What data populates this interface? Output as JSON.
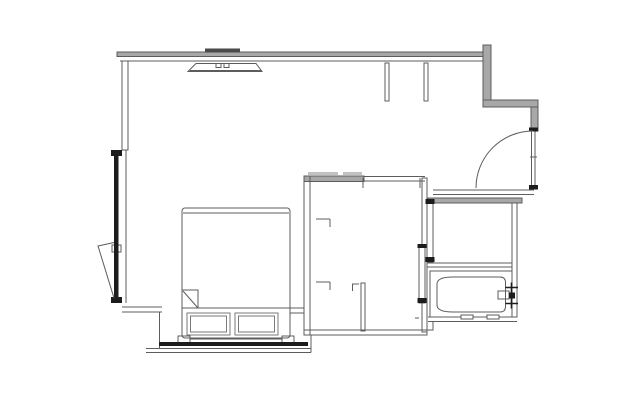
{
  "canvas": {
    "width": 640,
    "height": 400,
    "background": "#ffffff"
  },
  "colors": {
    "line": "#5c5c5c",
    "line_light": "#7a7a7a",
    "dark": "#1c1c1c",
    "mid_dark": "#4a4a4a",
    "wall_fill": "#a8a8a8",
    "wall_fill_light": "#c2c2c2",
    "white": "#ffffff"
  },
  "floorplan": {
    "elements": [
      {
        "type": "band",
        "name": "top-wall-band",
        "x": 117,
        "y": 52,
        "w": 366,
        "h": 4.5
      },
      {
        "type": "band",
        "name": "entry-left-wall-band",
        "x": 483,
        "y": 45,
        "w": 8,
        "h": 62
      },
      {
        "type": "band",
        "name": "entry-top-wall-band",
        "x": 483,
        "y": 100,
        "w": 55,
        "h": 7
      },
      {
        "type": "band",
        "name": "entry-right-wall-band",
        "x": 531,
        "y": 107,
        "w": 7,
        "h": 24
      },
      {
        "type": "band",
        "name": "bathroom-top-wall-band",
        "x": 428,
        "y": 198,
        "w": 94,
        "h": 5
      },
      {
        "type": "band",
        "name": "closet-top-wall-band",
        "x": 304,
        "y": 176,
        "w": 60,
        "h": 5.5
      },
      {
        "type": "band",
        "name": "closet-shelf-bar-1",
        "x": 308,
        "y": 172,
        "w": 30,
        "h": 3,
        "fill": "wall_fill_light",
        "nostroke": true
      },
      {
        "type": "band",
        "name": "closet-shelf-bar-2",
        "x": 343,
        "y": 172,
        "w": 19,
        "h": 3,
        "fill": "wall_fill_light",
        "nostroke": true
      },
      {
        "type": "line",
        "name": "top-wall-inner-line",
        "x1": 120,
        "y1": 61,
        "x2": 483,
        "y2": 61
      },
      {
        "type": "line",
        "name": "closet-top-wall-line-a",
        "x1": 363,
        "y1": 176.5,
        "x2": 425,
        "y2": 176.5
      },
      {
        "type": "line",
        "name": "closet-top-wall-line-b",
        "x1": 363,
        "y1": 181,
        "x2": 425,
        "y2": 181
      },
      {
        "type": "line",
        "name": "corridor-wall-line-a",
        "x1": 433,
        "y1": 190,
        "x2": 534,
        "y2": 190
      },
      {
        "type": "line",
        "name": "corridor-wall-line-b",
        "x1": 433,
        "y1": 194.5,
        "x2": 534,
        "y2": 194.5
      },
      {
        "type": "line",
        "name": "bath-divider-line-a",
        "x1": 427,
        "y1": 263,
        "x2": 512,
        "y2": 263
      },
      {
        "type": "line",
        "name": "bath-divider-line-b",
        "x1": 427,
        "y1": 267,
        "x2": 512,
        "y2": 267
      },
      {
        "type": "line",
        "name": "bath-bottom-wall-a",
        "x1": 428,
        "y1": 317,
        "x2": 517,
        "y2": 317
      },
      {
        "type": "line",
        "name": "bath-bottom-wall-b",
        "x1": 428,
        "y1": 321.5,
        "x2": 517,
        "y2": 321.5
      },
      {
        "type": "line",
        "name": "left-wall-inner-face",
        "x1": 126,
        "y1": 150,
        "x2": 126,
        "y2": 303
      },
      {
        "type": "line",
        "name": "lower-left-wall-a",
        "x1": 122,
        "y1": 307,
        "x2": 162,
        "y2": 307
      },
      {
        "type": "line",
        "name": "lower-left-wall-b",
        "x1": 122,
        "y1": 312,
        "x2": 162,
        "y2": 312
      },
      {
        "type": "line",
        "name": "lower-left-step",
        "x1": 159.5,
        "y1": 312,
        "x2": 159.5,
        "y2": 348.5
      },
      {
        "type": "line",
        "name": "headboard-ledge-a",
        "x1": 290,
        "y1": 308,
        "x2": 304,
        "y2": 308
      },
      {
        "type": "line",
        "name": "headboard-ledge-b",
        "x1": 290,
        "y1": 313,
        "x2": 304,
        "y2": 313
      },
      {
        "type": "line",
        "name": "bottom-wall-line-a",
        "x1": 146,
        "y1": 348.5,
        "x2": 311,
        "y2": 348.5
      },
      {
        "type": "line",
        "name": "bottom-wall-line-b",
        "x1": 146,
        "y1": 352.5,
        "x2": 311,
        "y2": 352.5
      },
      {
        "type": "line",
        "name": "bottom-wall-right-end",
        "x1": 311,
        "y1": 335,
        "x2": 311,
        "y2": 352.5
      },
      {
        "type": "line",
        "name": "headboard-line",
        "x1": 178,
        "y1": 339,
        "x2": 294,
        "y2": 339
      },
      {
        "type": "line",
        "name": "duvet-edge-line",
        "x1": 182,
        "y1": 308,
        "x2": 290,
        "y2": 308
      },
      {
        "type": "line",
        "name": "bed-foot-inner-line",
        "x1": 183,
        "y1": 213,
        "x2": 289,
        "y2": 213
      },
      {
        "type": "line",
        "name": "closet-jamb-tick-1",
        "x1": 363,
        "y1": 178,
        "x2": 363,
        "y2": 188
      },
      {
        "type": "line",
        "name": "closet-jamb-tick-2",
        "x1": 420,
        "y1": 178,
        "x2": 420,
        "y2": 188
      },
      {
        "type": "line",
        "name": "closet-bracket-1-h",
        "x1": 316,
        "y1": 219,
        "x2": 330,
        "y2": 219
      },
      {
        "type": "line",
        "name": "closet-bracket-1-v",
        "x1": 330,
        "y1": 219,
        "x2": 330,
        "y2": 227
      },
      {
        "type": "line",
        "name": "closet-bracket-2-h",
        "x1": 316,
        "y1": 282,
        "x2": 330,
        "y2": 282
      },
      {
        "type": "line",
        "name": "closet-bracket-2-v",
        "x1": 330,
        "y1": 282,
        "x2": 330,
        "y2": 290
      },
      {
        "type": "line",
        "name": "closet-bracket-3-h",
        "x1": 352,
        "y1": 284,
        "x2": 359,
        "y2": 284
      },
      {
        "type": "line",
        "name": "closet-bracket-3-v",
        "x1": 352.5,
        "y1": 284,
        "x2": 352.5,
        "y2": 291
      },
      {
        "type": "line",
        "name": "closet-wall-dash",
        "x1": 415,
        "y1": 318,
        "x2": 419,
        "y2": 318
      },
      {
        "type": "line",
        "name": "door-leaf-tick",
        "x1": 530,
        "y1": 157,
        "x2": 537,
        "y2": 157
      },
      {
        "type": "line",
        "name": "ac-unit-inner-line",
        "x1": 190,
        "y1": 70.5,
        "x2": 261,
        "y2": 70.5
      },
      {
        "type": "rect",
        "name": "left-wall",
        "x": 122,
        "y": 61,
        "w": 6,
        "h": 89
      },
      {
        "type": "rect",
        "name": "window-pivot-bracket",
        "x": 112,
        "y": 245,
        "w": 9,
        "h": 7,
        "fill": "white"
      },
      {
        "type": "rect",
        "name": "closet-left-wall",
        "x": 304,
        "y": 176,
        "w": 6,
        "h": 159
      },
      {
        "type": "rect",
        "name": "closet-right-wall",
        "x": 422,
        "y": 178,
        "w": 5,
        "h": 154
      },
      {
        "type": "rect",
        "name": "closet-bottom-wall",
        "x": 304,
        "y": 330,
        "w": 123,
        "h": 5
      },
      {
        "type": "rect",
        "name": "closet-divider-wall",
        "x": 361,
        "y": 283,
        "w": 4,
        "h": 48
      },
      {
        "type": "rect",
        "name": "bath-right-wall",
        "x": 512,
        "y": 203,
        "w": 5,
        "h": 114
      },
      {
        "type": "rect",
        "name": "bathtub-enclosure",
        "x": 430,
        "y": 271,
        "w": 82,
        "h": 46
      },
      {
        "type": "rect",
        "name": "bathtub-drain-tick-1",
        "x": 461,
        "y": 315,
        "w": 12,
        "h": 4,
        "fill": "white"
      },
      {
        "type": "rect",
        "name": "bathtub-drain-tick-2",
        "x": 487,
        "y": 315,
        "w": 12,
        "h": 4,
        "fill": "white"
      },
      {
        "type": "rect",
        "name": "bathtub-spout",
        "x": 498,
        "y": 291,
        "w": 11,
        "h": 8,
        "fill": "white"
      },
      {
        "type": "rect",
        "name": "sliding-door-panel-1",
        "x": 427,
        "y": 200,
        "w": 6,
        "h": 62,
        "fill": "white"
      },
      {
        "type": "rect",
        "name": "sliding-door-panel-2",
        "x": 419,
        "y": 245,
        "w": 6,
        "h": 58,
        "fill": "white"
      },
      {
        "type": "rect",
        "name": "wall-stub-1",
        "x": 385,
        "y": 63,
        "w": 4,
        "h": 38
      },
      {
        "type": "rect",
        "name": "wall-stub-2",
        "x": 424,
        "y": 63,
        "w": 4,
        "h": 38
      },
      {
        "type": "rect",
        "name": "pillow-1-outer",
        "x": 187,
        "y": 313,
        "w": 43,
        "h": 22,
        "color": "line_light"
      },
      {
        "type": "rect",
        "name": "pillow-1-inner",
        "x": 190.5,
        "y": 316,
        "w": 36,
        "h": 16,
        "color": "line_light"
      },
      {
        "type": "rect",
        "name": "pillow-2-outer",
        "x": 235,
        "y": 313,
        "w": 43,
        "h": 22,
        "color": "line_light"
      },
      {
        "type": "rect",
        "name": "pillow-2-inner",
        "x": 238.5,
        "y": 316,
        "w": 36,
        "h": 16,
        "color": "line_light"
      },
      {
        "type": "rect",
        "name": "headboard-foot-left",
        "x": 178,
        "y": 336,
        "w": 12,
        "h": 6.5,
        "fill": "white"
      },
      {
        "type": "rect",
        "name": "headboard-foot-right",
        "x": 282,
        "y": 336,
        "w": 12,
        "h": 6.5,
        "fill": "white"
      },
      {
        "type": "rect",
        "name": "bed-frame",
        "x": 182,
        "y": 208,
        "w": 108,
        "h": 130,
        "rx": 3
      },
      {
        "type": "rect",
        "name": "duvet-fold-corner",
        "x": 182,
        "y": 290,
        "w": 16,
        "h": 18
      },
      {
        "type": "rect",
        "name": "door-leaf",
        "x": 531.5,
        "y": 130,
        "w": 3.5,
        "h": 58
      },
      {
        "type": "rect",
        "name": "ac-unit-vent-1",
        "x": 216,
        "y": 63.5,
        "w": 5,
        "h": 4
      },
      {
        "type": "rect",
        "name": "ac-unit-vent-2",
        "x": 224,
        "y": 63.5,
        "w": 5,
        "h": 4
      },
      {
        "type": "fillrect",
        "name": "window-top-cap",
        "x": 111,
        "y": 150,
        "w": 11,
        "h": 6,
        "fill": "dark"
      },
      {
        "type": "fillrect",
        "name": "window-glass-bar",
        "x": 114,
        "y": 156,
        "w": 4.5,
        "h": 141,
        "fill": "dark"
      },
      {
        "type": "fillrect",
        "name": "window-bottom-cap",
        "x": 111,
        "y": 297,
        "w": 11,
        "h": 6,
        "fill": "dark"
      },
      {
        "type": "fillrect",
        "name": "headboard-wall-bar",
        "x": 159,
        "y": 342,
        "w": 149,
        "h": 4,
        "fill": "dark"
      },
      {
        "type": "fillrect",
        "name": "door-hinge-top",
        "x": 529,
        "y": 127.5,
        "w": 9,
        "h": 4,
        "fill": "dark"
      },
      {
        "type": "fillrect",
        "name": "door-hinge-bottom",
        "x": 529,
        "y": 185,
        "w": 9,
        "h": 4.5,
        "fill": "dark"
      },
      {
        "type": "fillrect",
        "name": "ac-unit-wall-bar",
        "x": 205,
        "y": 48.5,
        "w": 35,
        "h": 4,
        "fill": "mid_dark"
      },
      {
        "type": "fillrect",
        "name": "slide-cap-1a",
        "x": 425.5,
        "y": 199,
        "w": 9,
        "h": 5,
        "fill": "dark"
      },
      {
        "type": "fillrect",
        "name": "slide-cap-1b",
        "x": 425.5,
        "y": 257,
        "w": 9,
        "h": 5,
        "fill": "dark"
      },
      {
        "type": "fillrect",
        "name": "slide-cap-2a",
        "x": 417.5,
        "y": 244,
        "w": 9,
        "h": 4,
        "fill": "dark"
      },
      {
        "type": "fillrect",
        "name": "slide-cap-2b",
        "x": 417.5,
        "y": 298,
        "w": 9,
        "h": 5,
        "fill": "dark"
      },
      {
        "type": "fillrect",
        "name": "faucet-hub",
        "x": 509,
        "y": 292.5,
        "w": 6,
        "h": 6,
        "fill": "dark"
      },
      {
        "type": "path",
        "name": "door-swing-arc",
        "d": "M533,131 A57 57 0 0 0 476,188"
      },
      {
        "type": "path",
        "name": "casement-window-swing",
        "d": "M114,242.5 L98,246 L114,298"
      },
      {
        "type": "path",
        "name": "duvet-fold-diagonal",
        "d": "M183,291 L197.5,307.5"
      },
      {
        "type": "path",
        "name": "bathtub-basin",
        "d": "M500,277 H453 Q437,277 437,284 V305 Q437,312 453,312 H500 Q505.5,312 505.5,306.5 V282.5 Q505.5,277 500,277 Z"
      },
      {
        "type": "path",
        "name": "ac-unit-body",
        "d": "M196,63.5 H256 L262,71.5 H188 Z"
      },
      {
        "type": "path",
        "name": "bath-corner-step",
        "d": "M427,330 L433,330 L433,322"
      },
      {
        "type": "path",
        "name": "faucet-handle-top",
        "d": "M505.5,287.5 H518 M511.5,282.5 V292.5",
        "color": "dark",
        "w2": 1.6
      },
      {
        "type": "path",
        "name": "faucet-handle-bottom",
        "d": "M505.5,303.5 H518 M511.5,298.5 V308.5",
        "color": "dark",
        "w2": 1.6
      }
    ]
  }
}
